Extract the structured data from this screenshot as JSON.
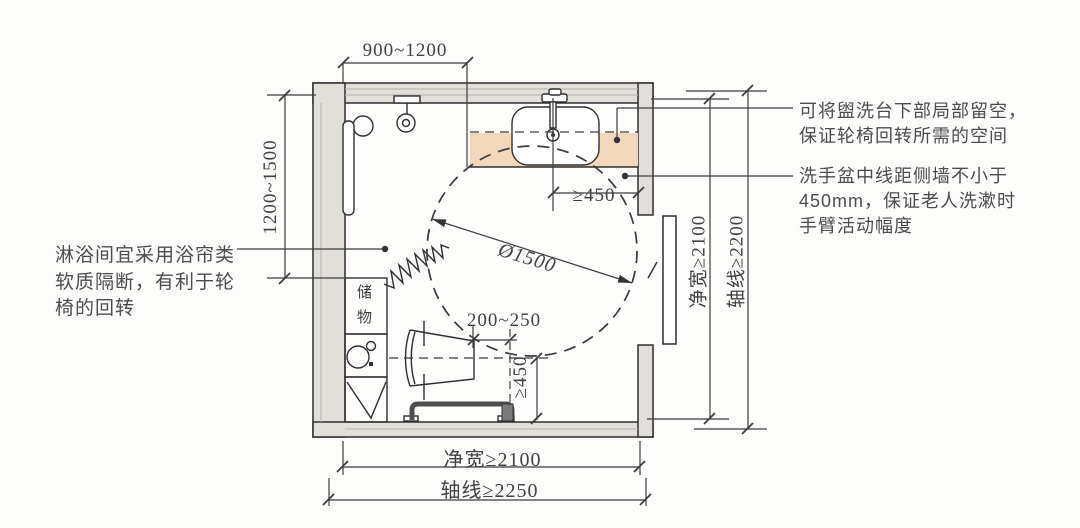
{
  "colors": {
    "background": "#fdfdfc",
    "wall_fill": "#e2dfdb",
    "counter_fill": "#f1d7bb",
    "line": "#2f2f2f",
    "text": "#414141"
  },
  "plan": {
    "storage_label": "储物"
  },
  "dimensions": {
    "top_width": "900~1200",
    "shower_depth": "1200~1500",
    "sink_center_to_side_wall": "≥450",
    "toilet_front_clearance": "200~250",
    "toilet_center_to_wall": "≥450",
    "turning_circle_diameter": "Ø1500",
    "bottom_clear_width": "净宽≥2100",
    "bottom_axis_width": "轴线≥2250",
    "right_clear_depth": "净宽≥2100",
    "right_axis_depth": "轴线≥2200"
  },
  "annotations": {
    "shower_note": "淋浴间宜采用浴帘类软质隔断，有利于轮椅的回转",
    "basin_underspace_note": "可将盥洗台下部局部留空，保证轮椅回转所需的空间",
    "basin_clearance_note": "洗手盆中线距侧墙不小于450mm，保证老人洗漱时手臂活动幅度"
  }
}
